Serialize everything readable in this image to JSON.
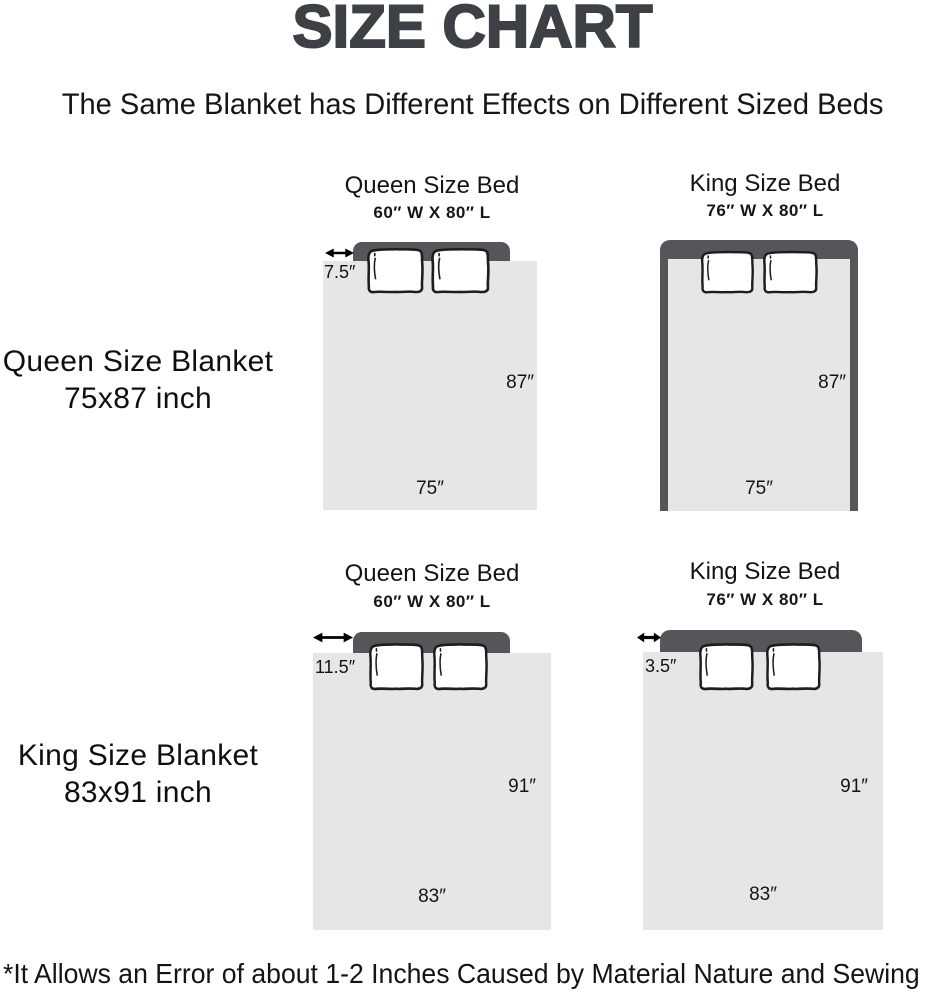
{
  "title": "SIZE CHART",
  "subtitle": "The Same Blanket has Different Effects on Different Sized Beds",
  "footnote": "*It Allows an Error of about 1-2 Inches Caused by Material Nature and Sewing",
  "colors": {
    "bed_frame": "#545659",
    "blanket": "#e6e6e7",
    "title": "#3d4044",
    "text": "#141414"
  },
  "rows": [
    {
      "blanket_name": "Queen Size Blanket",
      "blanket_size": "75x87 inch",
      "diagrams": [
        {
          "bed_name": "Queen Size Bed",
          "bed_size": "60″ W X 80″ L",
          "overhang": "7.5″",
          "length": "87″",
          "width": "75″"
        },
        {
          "bed_name": "King Size Bed",
          "bed_size": "76″ W X 80″ L",
          "length": "87″",
          "width": "75″"
        }
      ]
    },
    {
      "blanket_name": "King Size Blanket",
      "blanket_size": "83x91 inch",
      "diagrams": [
        {
          "bed_name": "Queen Size Bed",
          "bed_size": "60″ W X 80″ L",
          "overhang": "11.5″",
          "length": "91″",
          "width": "83″"
        },
        {
          "bed_name": "King Size Bed",
          "bed_size": "76″ W X 80″ L",
          "overhang": "3.5″",
          "length": "91″",
          "width": "83″"
        }
      ]
    }
  ]
}
